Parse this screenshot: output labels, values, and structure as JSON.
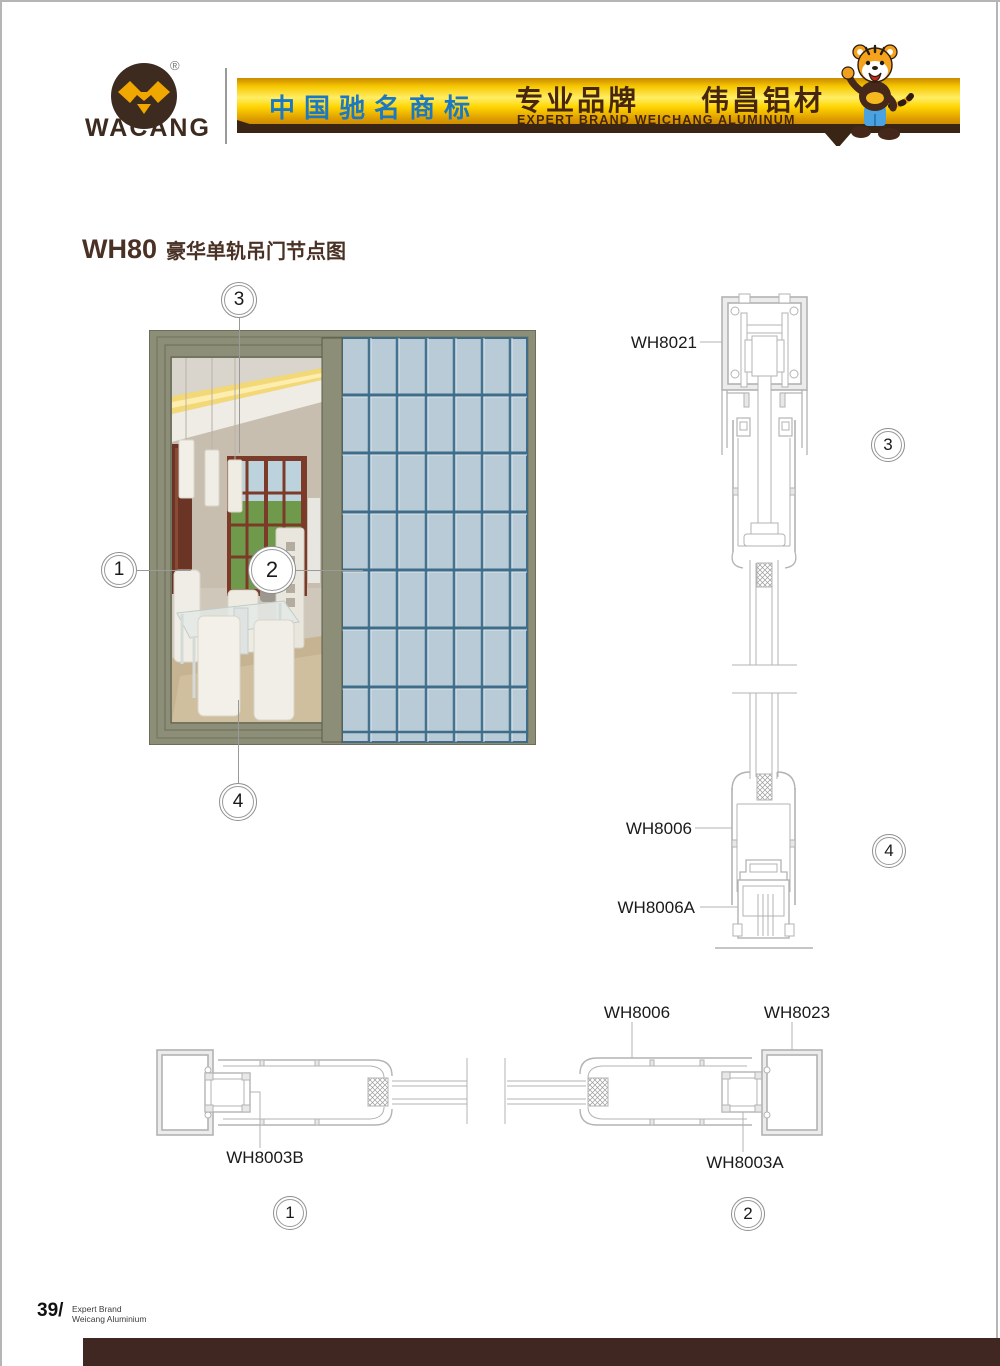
{
  "header": {
    "brand": "WACANG",
    "registered": "®",
    "banner_cn_blue": "中国驰名商标",
    "banner_cn_brown": "专业品牌　　伟昌铝材",
    "banner_en": "EXPERT BRAND WEICHANG ALUMINUM",
    "colors": {
      "banner_gold": "#ffd400",
      "banner_strip_brown": "#3a2413",
      "blue_text": "#1b78c2",
      "brown_text": "#46260e",
      "logo_brown": "#3e2b1f",
      "logo_gold": "#f0a800"
    }
  },
  "title": {
    "code": "WH80",
    "text": "豪华单轨吊门节点图"
  },
  "callouts": {
    "c1": "1",
    "c2": "2",
    "c3": "3",
    "c4": "4"
  },
  "labels": {
    "wh8021": "WH8021",
    "wh8006": "WH8006",
    "wh8006a": "WH8006A",
    "wh8023": "WH8023",
    "wh8003a": "WH8003A",
    "wh8003b": "WH8003B"
  },
  "elevation_colors": {
    "frame_olive": "#8d8e77",
    "glass_panel": "#b8cbd6",
    "glass_grid_line": "#3f6d89"
  },
  "footer": {
    "page_no": "39/",
    "line1": "Expert Brand",
    "line2": "Weicang Aluminium"
  }
}
